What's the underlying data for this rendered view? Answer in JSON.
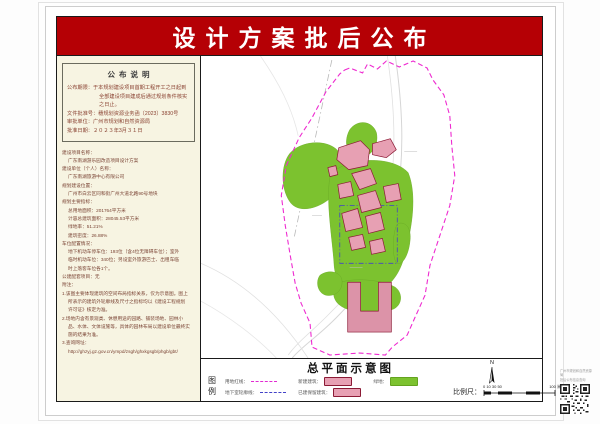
{
  "page": {
    "title": "设计方案批后公布"
  },
  "notice": {
    "title": "公布说明",
    "rows": [
      {
        "label": "公布期限：",
        "value": "于本规划建设项目首期工程开工之日起到全部建设项目建成后通过规划条件核实之日止。"
      },
      {
        "label": "文件批准号：",
        "value": "穗规划资源业务函〔2023〕3830号"
      },
      {
        "label": "审批单位：",
        "value": "广州市规划和自然资源局"
      },
      {
        "label": "批准日期：",
        "value": "２０２３年3月３１日"
      }
    ]
  },
  "details": {
    "lines": [
      {
        "text": "建设项目名称：",
        "indent": 0
      },
      {
        "text": "广东南湖游乐园改造项目设计方案",
        "indent": 1
      },
      {
        "text": "建设单位（个人）名称：",
        "indent": 0
      },
      {
        "text": "广东南湖旅游中心有限公司",
        "indent": 1
      },
      {
        "text": "规划建设位置：",
        "indent": 0
      },
      {
        "text": "广州市白云区同和街广州大道北路90号地块",
        "indent": 1
      },
      {
        "text": "规划主要指标：",
        "indent": 0
      },
      {
        "text": "总用地面积：201764平方米",
        "indent": 1
      },
      {
        "text": "计容总建筑面积：28045.53平方米",
        "indent": 1
      },
      {
        "text": "绿地率：51.21%",
        "indent": 1
      },
      {
        "text": "建筑密度：26.88%",
        "indent": 1
      },
      {
        "text": "车位配置情况：",
        "indent": 0
      },
      {
        "text": "地下机动车停车位：193位（含4位无障碍车位）；室外",
        "indent": 1
      },
      {
        "text": "临时机动车位：340位；另设室外旅游巴士、出租车临",
        "indent": 1
      },
      {
        "text": "时上落客车位各1个。",
        "indent": 1
      },
      {
        "text": "公建配套项目：无",
        "indent": 0
      },
      {
        "text": "附注：",
        "indent": 0
      },
      {
        "text": "1.该图主要体现建筑的空间布局指标关系，仅为示意图。图上",
        "indent": 0
      },
      {
        "text": "所表示的建筑外轮廓线及尺寸之指标均以《建设工程规划",
        "indent": 1
      },
      {
        "text": "许可证》核定为准。",
        "indent": 1
      },
      {
        "text": "2.场地内含有景观类、休憩用途的园路、铺装场地、园林小",
        "indent": 0
      },
      {
        "text": "品、水体、文体设施等，具体的园林布局以建设单位最终实",
        "indent": 1
      },
      {
        "text": "施的结果为准。",
        "indent": 1
      },
      {
        "text": "3.查询网址：",
        "indent": 0
      },
      {
        "text": "http://ghzyj.gz.gov.cn/ympd/zsgh/ghxkgsgb/phgb/gbt/",
        "indent": 1
      }
    ]
  },
  "map": {
    "title": "总平面示意图",
    "legend_label": "图例",
    "legend": [
      {
        "label": "用地红线：",
        "type": "line-magenta"
      },
      {
        "label": "地下室轮廓线：",
        "type": "line-blue"
      },
      {
        "label": "新建建筑：",
        "type": "box-pink"
      },
      {
        "label": "已建保留建筑：",
        "type": "box-pink"
      },
      {
        "label": "绿地：",
        "type": "box-green"
      }
    ],
    "north_label": "N",
    "scale": {
      "label": "比例尺：",
      "ticks": "0 10 30 50",
      "end": "100 米"
    }
  },
  "qr": {
    "caption_line1": "广州市规划和自然资源局",
    "caption_line2": "批后公布信息查询"
  },
  "colors": {
    "banner_red": "#b50005",
    "panel_beige": "#f7f4e2",
    "green_area": "#7cc22f",
    "building_fill": "#e7a0b3",
    "building_stroke": "#8b1a35",
    "site_boundary": "#ee2ad0",
    "underground_line": "#4343c8"
  }
}
